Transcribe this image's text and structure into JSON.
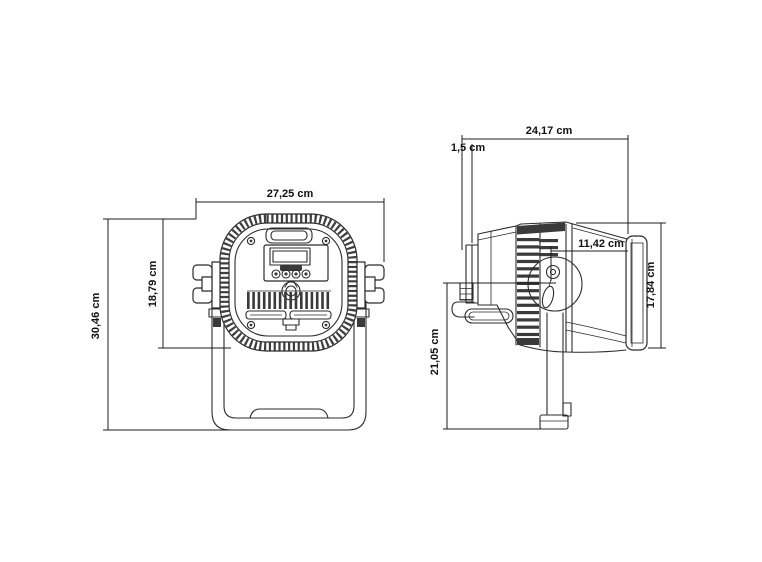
{
  "drawing": {
    "type": "technical dimension drawing",
    "subject": "LED PAR stage light fixture, rear view and side view with dimensions",
    "front_view": {
      "width": "27,25 cm",
      "body_height": "18,79 cm",
      "total_height": "30,46 cm"
    },
    "side_view": {
      "depth": "24,17 cm",
      "rear_offset": "1,5 cm",
      "front_section": "11,42 cm",
      "front_height": "17,84 cm",
      "bracket_height": "21,05 cm"
    }
  },
  "colors": {
    "line": "#2b2b2b",
    "dark_fill": "#3a3a3a",
    "background": "#ffffff",
    "label": "#111111"
  }
}
